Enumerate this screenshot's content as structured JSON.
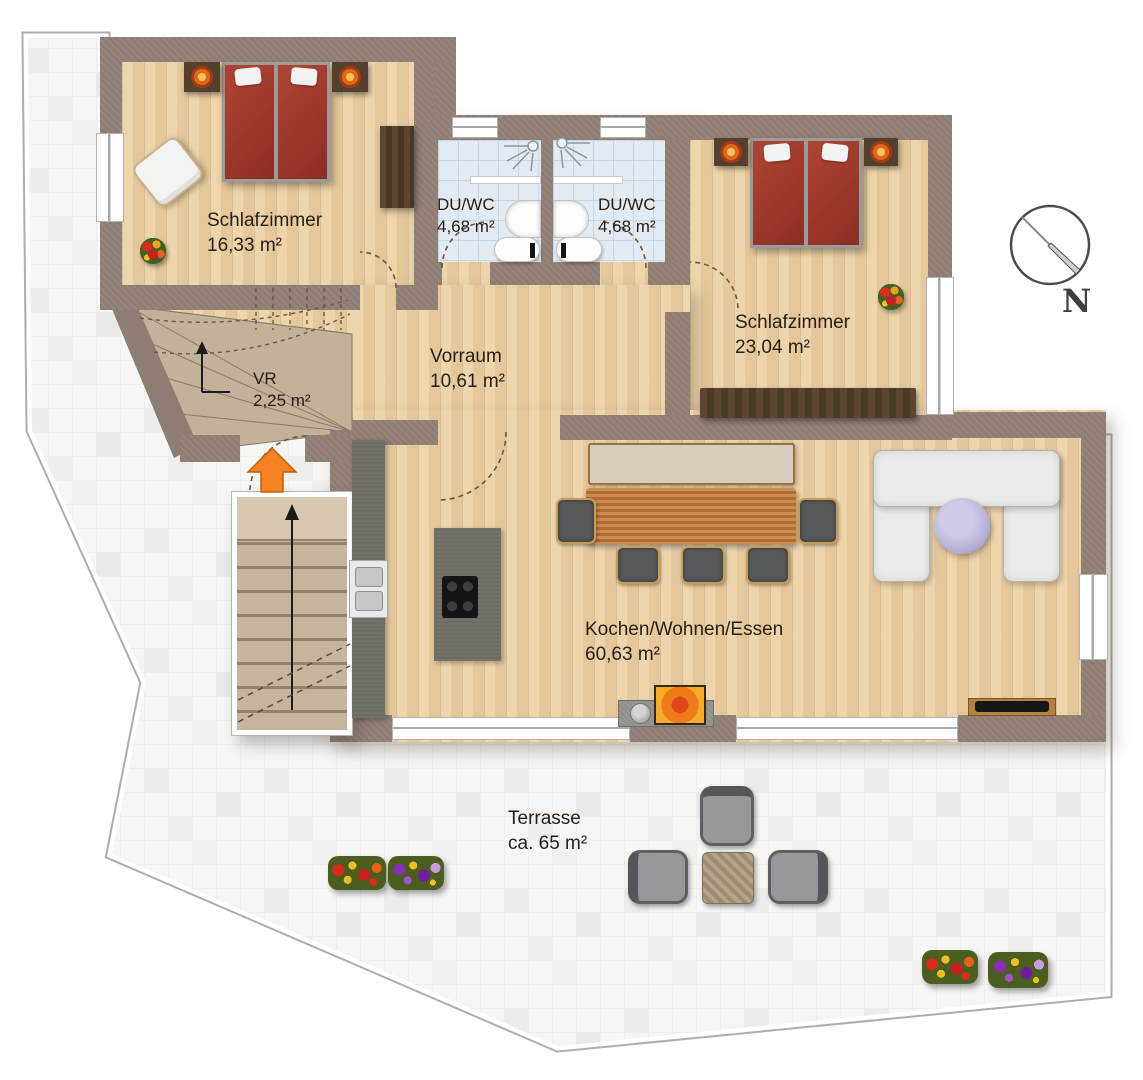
{
  "rooms": {
    "bedroom1": {
      "name": "Schlafzimmer",
      "area": "16,33 m²"
    },
    "bath1": {
      "name": "DU/WC",
      "area": "4,68 m²"
    },
    "bath2": {
      "name": "DU/WC",
      "area": "4,68 m²"
    },
    "bedroom2": {
      "name": "Schlafzimmer",
      "area": "23,04 m²"
    },
    "vorraum": {
      "name": "Vorraum",
      "area": "10,61 m²"
    },
    "vr": {
      "name": "VR",
      "area": "2,25 m²"
    },
    "living": {
      "name": "Kochen/Wohnen/Essen",
      "area": "60,63 m²"
    },
    "terrace": {
      "name": "Terrasse",
      "area": "ca. 65 m²"
    }
  },
  "compass": {
    "label": "N"
  },
  "icons": [
    "compass-icon",
    "entrance-arrow-icon",
    "shower-icon",
    "stairs-up-arrow-icon"
  ],
  "colors": {
    "wall": "#8e7d73",
    "wood_floor": "#ecd1a5",
    "bath_tile": "#e3ebf2",
    "terrace_tile": "#f6f6f5",
    "bed": "#a23a2c",
    "entrance_arrow": "#f58220",
    "kitchen_counter": "#6e6b64",
    "dining_table": "#c17a38",
    "sofa": "#ebebe9",
    "coffee_table": "#b2abd4",
    "stairs": "#c3b29a",
    "outdoor_furniture": "#6f7072",
    "label_text": "#281e14"
  }
}
